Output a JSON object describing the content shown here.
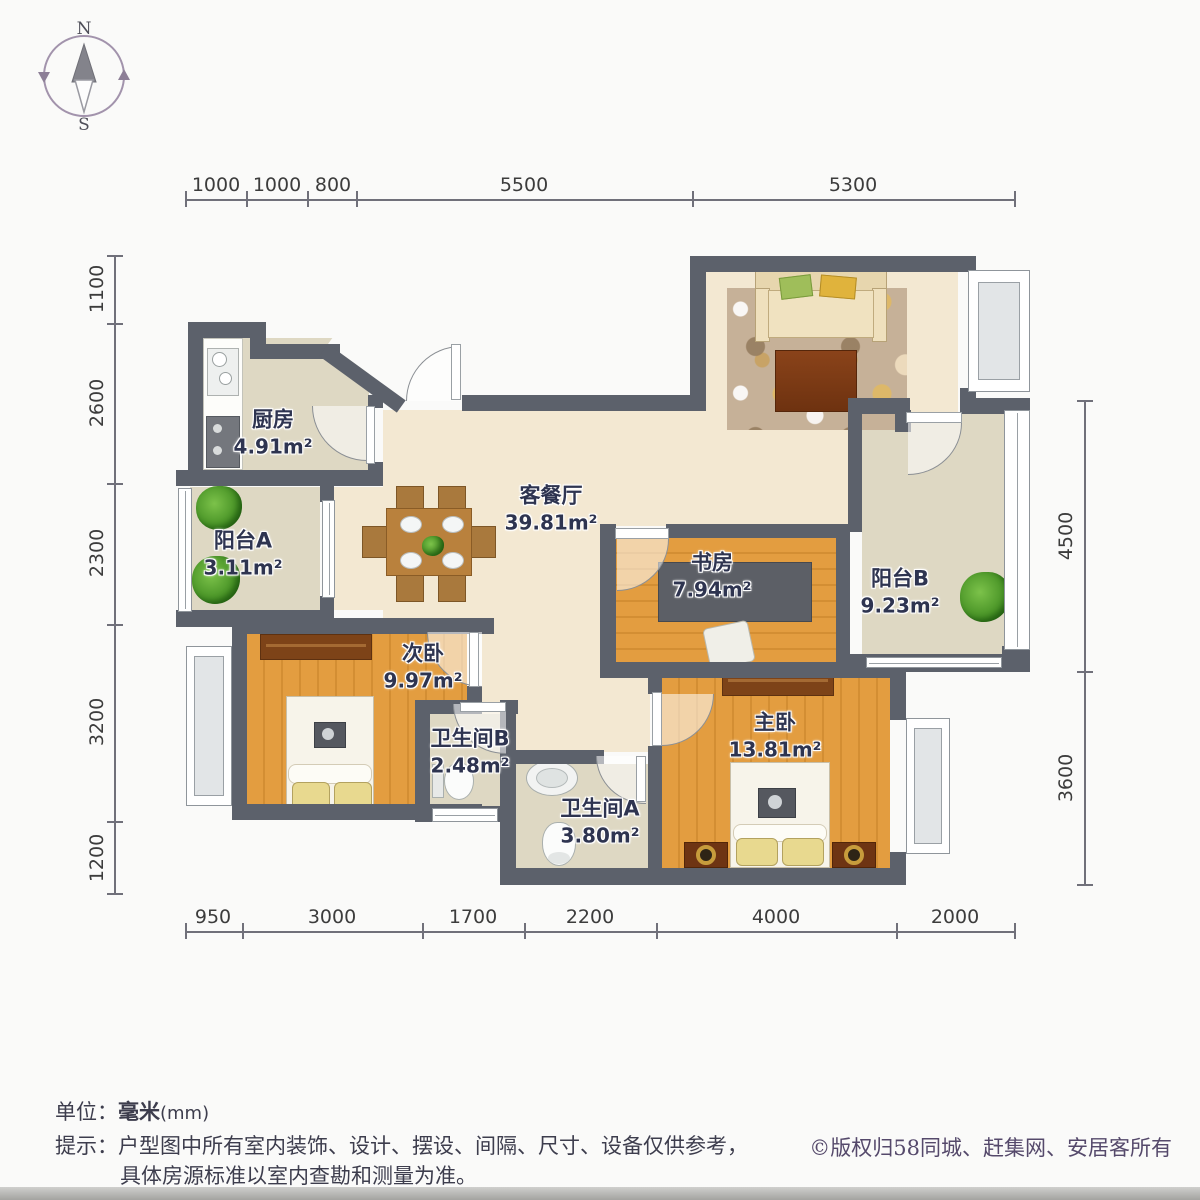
{
  "compass": {
    "north": "N",
    "south": "S"
  },
  "dims": {
    "top": [
      "1000",
      "1000",
      "800",
      "5500",
      "5300"
    ],
    "bottom": [
      "950",
      "3000",
      "1700",
      "2200",
      "4000",
      "2000"
    ],
    "left": [
      "1100",
      "2600",
      "2300",
      "3200",
      "1200"
    ],
    "right": [
      "4500",
      "3600"
    ]
  },
  "rooms": [
    {
      "id": "kitchen",
      "name": "厨房",
      "area": "4.91m²"
    },
    {
      "id": "balcony-a",
      "name": "阳台A",
      "area": "3.11m²"
    },
    {
      "id": "living-dining",
      "name": "客餐厅",
      "area": "39.81m²"
    },
    {
      "id": "study",
      "name": "书房",
      "area": "7.94m²"
    },
    {
      "id": "balcony-b",
      "name": "阳台B",
      "area": "9.23m²"
    },
    {
      "id": "bedroom-second",
      "name": "次卧",
      "area": "9.97m²"
    },
    {
      "id": "bathroom-b",
      "name": "卫生间B",
      "area": "2.48m²"
    },
    {
      "id": "bathroom-a",
      "name": "卫生间A",
      "area": "3.80m²"
    },
    {
      "id": "master-bedroom",
      "name": "主卧",
      "area": "13.81m²"
    }
  ],
  "footer": {
    "unit_label": "单位：",
    "unit_value": "毫米",
    "unit_suffix": "(mm)",
    "tip_label": "提示：",
    "tip_line1": "户型图中所有室内装饰、设计、摆设、间隔、尺寸、设备仅供参考，",
    "tip_line2": "具体房源标准以室内查勘和测量为准。",
    "copyright": "©版权归58同城、赶集网、安居客所有"
  },
  "colors": {
    "wall": "#5c616b",
    "floor_living": "#f3e8d2",
    "floor_tile": "#ded8c3",
    "floor_wood": "#e09a3e",
    "label_text": "#2e3450"
  }
}
